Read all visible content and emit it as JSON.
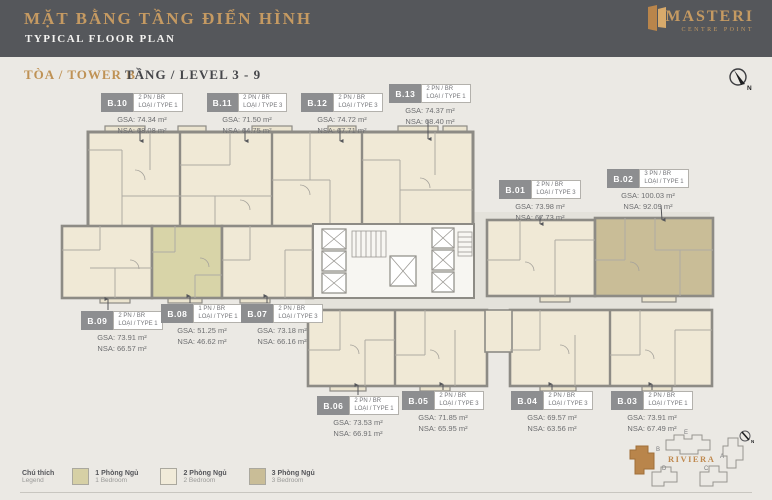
{
  "header": {
    "title_vi": "MẶT BẰNG TẦNG ĐIỂN HÌNH",
    "title_en": "TYPICAL FLOOR PLAN",
    "logo_name": "MASTERI",
    "logo_sub": "CENTRE POINT"
  },
  "subheader": {
    "tower": "TÒA / TOWER B",
    "level": "TẦNG / LEVEL 3 - 9",
    "compass_label": "N"
  },
  "units": [
    {
      "id": "B.01",
      "bed": "2 PN / BR",
      "type": "LOẠI / TYPE 3",
      "gsa": "GSA: 73.98 m²",
      "nsa": "NSA: 67.73 m²"
    },
    {
      "id": "B.02",
      "bed": "3 PN / BR",
      "type": "LOẠI / TYPE 1",
      "gsa": "GSA: 100.03 m²",
      "nsa": "NSA: 92.09 m²"
    },
    {
      "id": "B.03",
      "bed": "2 PN / BR",
      "type": "LOẠI / TYPE 1",
      "gsa": "GSA: 73.91 m²",
      "nsa": "NSA: 67.49 m²"
    },
    {
      "id": "B.04",
      "bed": "2 PN / BR",
      "type": "LOẠI / TYPE 3",
      "gsa": "GSA: 69.57 m²",
      "nsa": "NSA: 63.56 m²"
    },
    {
      "id": "B.05",
      "bed": "2 PN / BR",
      "type": "LOẠI / TYPE 3",
      "gsa": "GSA: 71.85 m²",
      "nsa": "NSA: 65.95 m²"
    },
    {
      "id": "B.06",
      "bed": "2 PN / BR",
      "type": "LOẠI / TYPE 1",
      "gsa": "GSA: 73.53 m²",
      "nsa": "NSA: 66.91 m²"
    },
    {
      "id": "B.07",
      "bed": "2 PN / BR",
      "type": "LOẠI / TYPE 3",
      "gsa": "GSA: 73.18 m²",
      "nsa": "NSA: 66.16 m²"
    },
    {
      "id": "B.08",
      "bed": "1 PN / BR",
      "type": "LOẠI / TYPE 1",
      "gsa": "GSA: 51.25 m²",
      "nsa": "NSA: 46.62 m²"
    },
    {
      "id": "B.09",
      "bed": "2 PN / BR",
      "type": "LOẠI / TYPE 1",
      "gsa": "GSA: 73.91 m²",
      "nsa": "NSA: 66.57 m²"
    },
    {
      "id": "B.10",
      "bed": "2 PN / BR",
      "type": "LOẠI / TYPE 1",
      "gsa": "GSA: 74.34 m²",
      "nsa": "NSA: 68.08 m²"
    },
    {
      "id": "B.11",
      "bed": "2 PN / BR",
      "type": "LOẠI / TYPE 3",
      "gsa": "GSA: 71.50 m²",
      "nsa": "NSA: 64.75 m²"
    },
    {
      "id": "B.12",
      "bed": "2 PN / BR",
      "type": "LOẠI / TYPE 3",
      "gsa": "GSA: 74.72 m²",
      "nsa": "NSA: 67.71 m²"
    },
    {
      "id": "B.13",
      "bed": "2 PN / BR",
      "type": "LOẠI / TYPE 1",
      "gsa": "GSA: 74.37 m²",
      "nsa": "NSA: 68.40 m²"
    }
  ],
  "legend": {
    "title_vi": "Chú thích",
    "title_en": "Legend",
    "items": [
      {
        "label_vi": "1 Phòng Ngủ",
        "label_en": "1 Bedroom",
        "color": "#d6d0a5"
      },
      {
        "label_vi": "2 Phòng Ngủ",
        "label_en": "2 Bedroom",
        "color": "#f1ebd9"
      },
      {
        "label_vi": "3 Phòng Ngủ",
        "label_en": "3 Bedroom",
        "color": "#c9bd97"
      }
    ]
  },
  "minimap": {
    "site_label": "RIVIERA",
    "buildings": [
      "A",
      "B",
      "C",
      "D",
      "E"
    ],
    "highlighted_building": "B",
    "compass_label": "N"
  },
  "colors": {
    "header_bg": "#55575b",
    "accent_gold": "#c59a62",
    "unit_cream": "#f0e9d6",
    "unit_olive": "#d8d4a8",
    "unit_tan": "#c9bd97",
    "wall_gray": "#8d8b85",
    "corridor": "#e4e2db",
    "minimap_highlight": "#b9854b"
  }
}
